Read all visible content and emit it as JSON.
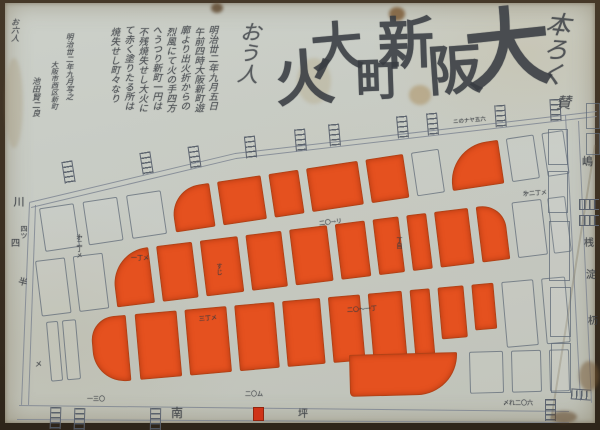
{
  "title": {
    "text": "大阪新町大火",
    "chars": [
      {
        "t": "大",
        "x": 460,
        "y": 4,
        "s": 86,
        "rot": -6
      },
      {
        "t": "阪",
        "x": 423,
        "y": 40,
        "s": 54,
        "rot": -4
      },
      {
        "t": "新",
        "x": 373,
        "y": 13,
        "s": 56,
        "rot": -2
      },
      {
        "t": "町",
        "x": 351,
        "y": 56,
        "s": 44,
        "rot": -2
      },
      {
        "t": "大",
        "x": 306,
        "y": 19,
        "s": 52,
        "rot": -5
      },
      {
        "t": "火",
        "x": 270,
        "y": 46,
        "s": 60,
        "rot": -4
      }
    ]
  },
  "flourishes": [
    {
      "t": "本ろく",
      "x": 534,
      "y": 8,
      "s": 25,
      "rot": 6,
      "o": 0.82,
      "v": 1
    },
    {
      "t": "賛",
      "x": 551,
      "y": 92,
      "s": 15,
      "rot": 0,
      "o": 0.8,
      "v": 0
    },
    {
      "t": "おう人",
      "x": 231,
      "y": 18,
      "s": 21,
      "rot": 4,
      "o": 0.78,
      "v": 1
    }
  ],
  "inscription": {
    "columns": [
      {
        "t": "明治丗二年九月五日",
        "x": 201,
        "y": 22,
        "s": 9.5
      },
      {
        "t": "午前四時大阪新町遊",
        "x": 187,
        "y": 24,
        "s": 9.5
      },
      {
        "t": "廓より出火折からの",
        "x": 173,
        "y": 22,
        "s": 9.5
      },
      {
        "t": "烈風にて火の手四方",
        "x": 159,
        "y": 24,
        "s": 9.5
      },
      {
        "t": "へうつり新町一円は",
        "x": 145,
        "y": 22,
        "s": 9.5
      },
      {
        "t": "不残焼失せし大火に",
        "x": 131,
        "y": 24,
        "s": 9.5
      },
      {
        "t": "て赤く塗りたる所は",
        "x": 117,
        "y": 22,
        "s": 9.5
      },
      {
        "t": "焼失せし町々なり",
        "x": 103,
        "y": 24,
        "s": 9.5
      },
      {
        "t": "明治丗二年九月写之",
        "x": 60,
        "y": 30,
        "s": 7.5
      },
      {
        "t": "大阪市西区新町",
        "x": 45,
        "y": 58,
        "s": 7
      },
      {
        "t": "池田賢二良",
        "x": 26,
        "y": 74,
        "s": 8
      },
      {
        "t": "お六人",
        "x": 5,
        "y": 15,
        "s": 8
      }
    ]
  },
  "map": {
    "colors": {
      "line": "#7b8290",
      "burn": "#e5511f",
      "ink": "#3a3e45"
    },
    "radii": {
      "tl": "30px 2px 2px 2px",
      "tl2": "40px 2px 2px 2px",
      "tr": "2px 24px 2px 2px",
      "bl": "24px 2px 2px 32px",
      "shoe": "2px 2px 58px 6px"
    },
    "lines": [
      {
        "x1": 24,
        "y1": 199,
        "x2": 230,
        "y2": 150
      },
      {
        "x1": 230,
        "y1": 150,
        "x2": 592,
        "y2": 108
      },
      {
        "x1": 26,
        "y1": 204,
        "x2": 231,
        "y2": 155
      },
      {
        "x1": 231,
        "y1": 155,
        "x2": 592,
        "y2": 113
      },
      {
        "x1": 14,
        "y1": 402,
        "x2": 564,
        "y2": 408
      },
      {
        "x1": 12,
        "y1": 416,
        "x2": 564,
        "y2": 419
      },
      {
        "x1": 25,
        "y1": 200,
        "x2": 17,
        "y2": 402
      },
      {
        "x1": 31,
        "y1": 202,
        "x2": 24,
        "y2": 402
      },
      {
        "x1": 561,
        "y1": 112,
        "x2": 576,
        "y2": 398
      },
      {
        "x1": 574,
        "y1": 118,
        "x2": 587,
        "y2": 400
      },
      {
        "x1": 591,
        "y1": 142,
        "x2": 547,
        "y2": 418,
        "w": 2,
        "c": "rgba(112,96,68,.35)"
      }
    ],
    "rows": [
      {
        "x": 30,
        "y": 206,
        "h": 44,
        "rot": -8.5,
        "blocks": [
          {
            "x": 4,
            "w": 35,
            "b": 0
          },
          {
            "x": 48,
            "w": 35,
            "b": 0
          },
          {
            "x": 92,
            "w": 35,
            "b": 0
          },
          {
            "x": 136,
            "w": 40,
            "b": 1,
            "r": "tl"
          },
          {
            "x": 184,
            "w": 44,
            "b": 1
          },
          {
            "x": 236,
            "w": 30,
            "b": 1
          },
          {
            "x": 274,
            "w": 52,
            "b": 1
          },
          {
            "x": 334,
            "w": 38,
            "b": 1
          },
          {
            "x": 380,
            "w": 28,
            "b": 0
          },
          {
            "x": 416,
            "w": 52,
            "b": 1,
            "r": "tl2"
          },
          {
            "x": 476,
            "w": 28,
            "b": 0
          },
          {
            "x": 512,
            "w": 22,
            "b": 0
          }
        ]
      },
      {
        "x": 30,
        "y": 258,
        "h": 56,
        "rot": -7,
        "blocks": [
          {
            "x": 0,
            "w": 30,
            "b": 0
          },
          {
            "x": 38,
            "w": 30,
            "b": 0
          },
          {
            "x": 76,
            "w": 38,
            "b": 1,
            "r": "tl2"
          },
          {
            "x": 122,
            "w": 36,
            "b": 1
          },
          {
            "x": 166,
            "w": 38,
            "b": 1
          },
          {
            "x": 212,
            "w": 36,
            "b": 1
          },
          {
            "x": 256,
            "w": 38,
            "b": 1
          },
          {
            "x": 302,
            "w": 30,
            "b": 1
          },
          {
            "x": 340,
            "w": 26,
            "b": 1
          },
          {
            "x": 374,
            "w": 20,
            "b": 1
          },
          {
            "x": 402,
            "w": 34,
            "b": 1
          },
          {
            "x": 444,
            "w": 28,
            "b": 1,
            "r": "tr"
          },
          {
            "x": 480,
            "w": 30,
            "b": 0
          },
          {
            "x": 516,
            "w": 18,
            "b": 0
          }
        ]
      },
      {
        "x": 28,
        "y": 320,
        "h": 66,
        "rot": -5,
        "blocks": [
          {
            "x": 13,
            "w": 12,
            "b": 0,
            "h": 60
          },
          {
            "x": 29,
            "w": 14,
            "b": 0,
            "h": 60
          },
          {
            "x": 57,
            "w": 36,
            "b": 1,
            "r": "bl"
          },
          {
            "x": 102,
            "w": 42,
            "b": 1
          },
          {
            "x": 152,
            "w": 42,
            "b": 1
          },
          {
            "x": 202,
            "w": 40,
            "b": 1
          },
          {
            "x": 250,
            "w": 38,
            "b": 1
          },
          {
            "x": 296,
            "w": 32,
            "b": 1
          },
          {
            "x": 336,
            "w": 34,
            "b": 1
          },
          {
            "x": 378,
            "w": 20,
            "b": 1
          },
          {
            "x": 406,
            "w": 26,
            "b": 1,
            "h": 52
          },
          {
            "x": 440,
            "w": 22,
            "b": 1,
            "h": 46
          },
          {
            "x": 470,
            "w": 32,
            "b": 0
          },
          {
            "x": 510,
            "w": 24,
            "b": 0
          }
        ]
      },
      {
        "x": 340,
        "y": 352,
        "h": 42,
        "rot": -1.5,
        "blocks": [
          {
            "x": 4,
            "w": 108,
            "b": 1,
            "r": "shoe"
          },
          {
            "x": 124,
            "w": 34,
            "b": 0
          },
          {
            "x": 166,
            "w": 30,
            "b": 0
          },
          {
            "x": 204,
            "w": 20,
            "b": 0
          }
        ]
      }
    ],
    "east_blocks": [
      {
        "x": 543,
        "y": 126,
        "w": 20,
        "h": 36
      },
      {
        "x": 543,
        "y": 168,
        "w": 20,
        "h": 42
      },
      {
        "x": 544,
        "y": 218,
        "w": 21,
        "h": 60
      },
      {
        "x": 545,
        "y": 284,
        "w": 21,
        "h": 50
      },
      {
        "x": 546,
        "y": 340,
        "w": 20,
        "h": 50
      },
      {
        "x": 581,
        "y": 100,
        "w": 14,
        "h": 26
      },
      {
        "x": 581,
        "y": 130,
        "w": 14,
        "h": 22
      }
    ],
    "bridges": [
      {
        "x": 58,
        "y": 158,
        "rot": -9
      },
      {
        "x": 136,
        "y": 149,
        "rot": -9
      },
      {
        "x": 184,
        "y": 143,
        "rot": -8
      },
      {
        "x": 240,
        "y": 133,
        "rot": -6
      },
      {
        "x": 290,
        "y": 126,
        "rot": -5
      },
      {
        "x": 324,
        "y": 121,
        "rot": -5
      },
      {
        "x": 392,
        "y": 113,
        "rot": -5
      },
      {
        "x": 422,
        "y": 110,
        "rot": -5
      },
      {
        "x": 490,
        "y": 102,
        "rot": -4
      },
      {
        "x": 545,
        "y": 96,
        "rot": -3
      },
      {
        "x": 45,
        "y": 404,
        "rot": 2
      },
      {
        "x": 69,
        "y": 405,
        "rot": 2
      },
      {
        "x": 145,
        "y": 405,
        "rot": 1
      },
      {
        "x": 540,
        "y": 396,
        "rot": 0
      },
      {
        "x": 574,
        "y": 196,
        "rot": 0,
        "hz": 1
      },
      {
        "x": 574,
        "y": 212,
        "rot": 0,
        "hz": 1
      },
      {
        "x": 566,
        "y": 386,
        "rot": 4,
        "hz": 1
      }
    ],
    "red_bridge": {
      "x": 248,
      "y": 404,
      "w": 11,
      "h": 14
    },
    "labels": [
      {
        "t": "南",
        "x": 166,
        "y": 404,
        "s": 12
      },
      {
        "t": "坪",
        "x": 293,
        "y": 407,
        "s": 10
      },
      {
        "t": "川",
        "x": 8,
        "y": 193,
        "s": 11,
        "v": 1
      },
      {
        "t": "四",
        "x": 6,
        "y": 237,
        "s": 9
      },
      {
        "t": "半",
        "x": 13,
        "y": 276,
        "s": 9,
        "rot": 15
      },
      {
        "t": "嶋",
        "x": 577,
        "y": 153,
        "s": 11
      },
      {
        "t": "桟",
        "x": 579,
        "y": 236,
        "s": 10
      },
      {
        "t": "淀",
        "x": 581,
        "y": 268,
        "s": 10
      },
      {
        "t": "杤",
        "x": 583,
        "y": 314,
        "s": 10
      },
      {
        "t": "㐧二丁メ",
        "x": 70,
        "y": 231,
        "s": 6,
        "v": 1
      },
      {
        "t": "四ツ",
        "x": 15,
        "y": 222,
        "s": 7,
        "v": 1
      },
      {
        "t": "一丁メ",
        "x": 126,
        "y": 253,
        "s": 6
      },
      {
        "t": "二〇→リ",
        "x": 314,
        "y": 217,
        "s": 6,
        "rot": -7
      },
      {
        "t": "二〇〜一丁",
        "x": 342,
        "y": 304,
        "s": 6,
        "rot": -4
      },
      {
        "t": "三丁メ",
        "x": 194,
        "y": 313,
        "s": 6,
        "rot": -5
      },
      {
        "t": "一三〇",
        "x": 82,
        "y": 394,
        "s": 6
      },
      {
        "t": "二〇ム",
        "x": 240,
        "y": 389,
        "s": 6
      },
      {
        "t": "ニのナヤ五六",
        "x": 448,
        "y": 116,
        "s": 5.5,
        "rot": -5
      },
      {
        "t": "〆れ二〇六",
        "x": 498,
        "y": 398,
        "s": 6
      },
      {
        "t": "すじ",
        "x": 210,
        "y": 260,
        "s": 6,
        "v": 1
      },
      {
        "t": "丁目",
        "x": 390,
        "y": 234,
        "s": 6,
        "v": 1
      },
      {
        "t": "㐧二丁メ",
        "x": 518,
        "y": 188,
        "s": 6,
        "rot": -4
      },
      {
        "t": "メ",
        "x": 30,
        "y": 358,
        "s": 7
      }
    ]
  },
  "stains": [
    {
      "x": 206,
      "y": 0,
      "w": 12,
      "h": 10,
      "c": "rgba(90,66,40,.8)"
    },
    {
      "x": 384,
      "y": 4,
      "w": 16,
      "h": 14,
      "c": "rgba(125,92,55,.85)"
    },
    {
      "x": 404,
      "y": 82,
      "w": 22,
      "h": 20,
      "c": "rgba(170,140,90,.5)"
    },
    {
      "x": 292,
      "y": 55,
      "w": 34,
      "h": 46,
      "c": "rgba(178,162,122,.32)"
    },
    {
      "x": 574,
      "y": 358,
      "w": 20,
      "h": 30,
      "c": "rgba(118,88,52,.5)"
    },
    {
      "x": 546,
      "y": 408,
      "w": 26,
      "h": 12,
      "c": "rgba(96,70,40,.55)"
    },
    {
      "x": 0,
      "y": 55,
      "w": 18,
      "h": 90,
      "c": "rgba(160,140,100,.25)"
    }
  ]
}
